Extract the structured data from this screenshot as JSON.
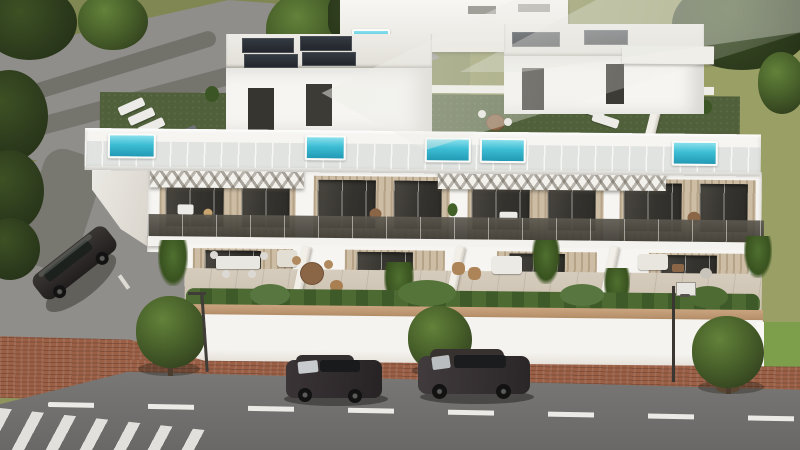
{
  "scene": {
    "type": "3d-architectural-render",
    "description": "Aerial 3D visualization of a row of four modern white townhouses with rooftop terraces, viewed from above a street.",
    "no_visible_text": true,
    "environment": {
      "ground": "olive-green lawn fields with gray access roads behind the building",
      "street": "gray asphalt road in the foreground with a white dashed center line and a zebra crosswalk at the lower-left corner",
      "sidewalk": "red-brown brick paved strip between the street and the property wall",
      "lighting": "bright daylight with a diagonal lens glare across the upper part of the image"
    },
    "building": {
      "style": "modern flat-roof townhouse block, white render with beige wood-slat accent panels",
      "floors": [
        "ground-floor terraces with outdoor furniture and planting",
        "first floor with glass-balustrade balconies and dark sliding doors",
        "roof deck with artificial turf, plunge pools, pergolas and stair boxes with solar panels"
      ],
      "units": 4,
      "rooftop_pools": 5,
      "pergolas": 2,
      "stair_boxes": 2,
      "solar_panels": 6,
      "perimeter_wall": "white wall with tan coping and a hedge planting strip on top"
    },
    "objects": [
      {
        "name": "back-building",
        "description": "second white villa with small rooftop pool behind the access road"
      },
      {
        "name": "rooftop-pool",
        "description": "small turquoise plunge pools set into the front roof parapet"
      },
      {
        "name": "roof-furniture",
        "description": "sun loungers, round dining tables and planters on green turf roof decks"
      },
      {
        "name": "balcony",
        "description": "continuous tinted-glass balustrade along the first floor"
      },
      {
        "name": "terrace-furniture",
        "description": "dining sets, wicker chairs and white sofas on the ground-floor patios"
      },
      {
        "name": "street-tree",
        "description": "three round-crown trees planted along the brick sidewalk"
      },
      {
        "name": "basketball-hoop",
        "description": "basketball hoop on a pole in the right-hand front yard"
      },
      {
        "name": "parked-suv",
        "description": "dark SUV parked on the side road at the left"
      },
      {
        "name": "hatchback-car",
        "description": "small dark hatchback driving on the street"
      },
      {
        "name": "suv-car",
        "description": "dark SUV driving on the street to the right"
      },
      {
        "name": "crosswalk",
        "description": "white zebra stripes at the lower-left street corner"
      },
      {
        "name": "lens-glare",
        "description": "translucent diagonal light streak across the top of the render"
      }
    ]
  },
  "palette": {
    "grass": "#8f945c",
    "grass_bright": "#9aa065",
    "grass_lawn": "#7d9e4a",
    "road": "#908e8a",
    "asphalt": "#747371",
    "brick": "#9a5f45",
    "bwhite": "#f6f5f2",
    "building_shade": "#e5e2db",
    "panel": "#23262b",
    "turf": "#50603a",
    "pool": "#3cbdd4",
    "tan_panel": "#cdbda4",
    "glass_dark": "#37352f",
    "railing": "#57524b",
    "coping": "#c09a76",
    "hedge": "#4d6a33",
    "tree_dark": "#2f3d1d",
    "tree_mid": "#48602a",
    "tree_light": "#63823a",
    "dash_white": "#eceae6",
    "car_dark": "#332e30",
    "shadow": "#2a2f1e"
  }
}
